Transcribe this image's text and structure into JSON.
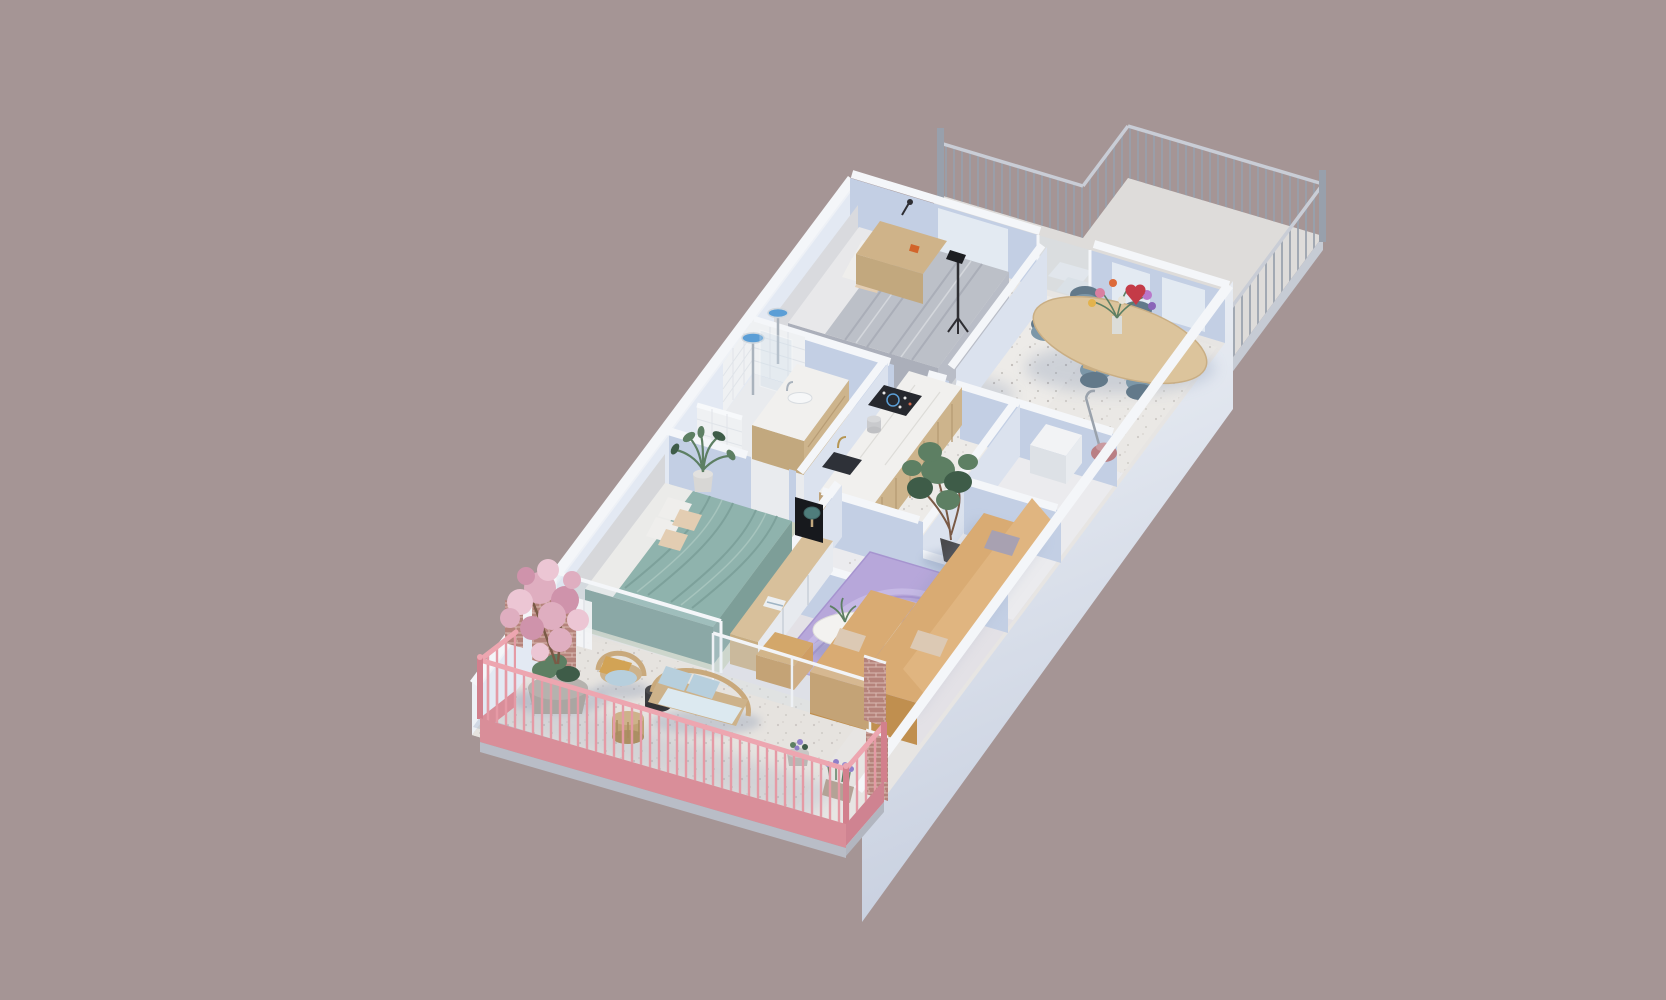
{
  "scene": {
    "title": "3D isometric cutaway floor plan of a furnished apartment with balcony and roof terrace",
    "view": "axonometric dollhouse render"
  },
  "colors": {
    "background": "#a59595",
    "terrace-floor": "#dedcda",
    "terrace-fascia": "#c6cbd4",
    "railing-metal": "#98a0ac",
    "railing-metal-rail": "#c9cdd6",
    "floor-base": "#e7e5e3",
    "floor-room": "#eae8e5",
    "floor-hall": "#edebe8",
    "floor-sage": "#ccd3c2",
    "floor-living": "#e3e1e6",
    "floor-bath": "#e9ebee",
    "floor-rooms": "#ebebee",
    "floor-balcony": "#e6e3df",
    "wall-top": "#f4f6f9",
    "wall-face-light": "#dbe2ee",
    "wall-face-shadow": "#c3cfe4",
    "wall-face-inner": "#e3e9f3",
    "wall-outer": "#eef1f6",
    "facade-top": "#f2f5f9",
    "facade-bottom": "#c7cfdf",
    "shadow-blue": "#7d8fae",
    "window-light": "#e9eef5",
    "duvet-gray": "#bcc0c8",
    "duvet-gray-dark": "#abafba",
    "sheet-white": "#e8e8ea",
    "headboard-gray": "#d9dade",
    "pillow-white": "#efeeec",
    "pillow-beige": "#e3cdb2",
    "bed-teal": "#8fb3ad",
    "bed-teal-dark": "#74968f",
    "wood-desk": "#cfb389",
    "table-wood": "#dcc49c",
    "chair-blue": "#7c97a8",
    "chair-blue-dark": "#62798a",
    "kitchen-wood": "#cdb48c",
    "kitchen-wood-dark": "#bfa37a",
    "marble-white": "#f1f0ee",
    "cooktop-black": "#26282e",
    "sink-dark": "#2e3138",
    "brass": "#b69653",
    "chrome": "#aab3bd",
    "console-wood": "#d8c09b",
    "lamp-teal": "#4f7d7c",
    "rug-lilac": "#b7a7da",
    "rug-lilac-light": "#c9bce6",
    "rug-lilac-dark": "#a694cf",
    "coffee-table-white": "#f3f2f0",
    "sofa-camel": "#d9ab73",
    "sofa-camel-side": "#cf9e63",
    "sofa-camel-front": "#c08f4f",
    "cushion-beige": "#dcc9b4",
    "cushion-gray": "#a8a1b1",
    "ottoman-camel": "#d3a76a",
    "rattan": "#c9a97c",
    "rattan-seat": "#cdb28a",
    "cushion-blue": "#b7cfdd",
    "seat-pale": "#dce9f0",
    "plant-green": "#5d7f63",
    "plant-green-dark": "#3e5c48",
    "trunk-brown": "#7a5a46",
    "pot-gray": "#c8c7c5",
    "pot-dark": "#4a4a4c",
    "blossom-pink": "#dfaec0",
    "blossom-pink-light": "#ecc6d4",
    "blossom-pink-deep": "#cf93ab",
    "brick": "#b5837b",
    "brick-light": "#d9b9b2",
    "railing-pink": "#e59aa5",
    "railing-pink-top": "#eda6b0",
    "railing-pink-dark": "#d2808d",
    "railing-pink-fascia": "#d98e99",
    "vacuum-pink": "#b97f84",
    "glass-tint": "#cfe0ec",
    "white-goods": "#f2f3f5",
    "white-goods-side": "#dde1e6",
    "tile-white": "#eff1f3"
  },
  "rooms": [
    {
      "id": "terrace",
      "label": "Roof terrace",
      "items": [
        "metal railing",
        "entry steps"
      ]
    },
    {
      "id": "master-bedroom",
      "label": "Master bedroom",
      "items": [
        "double bed",
        "gray duvet",
        "headboard",
        "wooden desk",
        "floor lamp"
      ]
    },
    {
      "id": "dining-room",
      "label": "Dining room",
      "items": [
        "oval wooden table",
        "six blue chairs",
        "flower bouquet"
      ]
    },
    {
      "id": "hallway",
      "label": "Hallway",
      "items": [
        "potted ficus tree"
      ]
    },
    {
      "id": "bathroom",
      "label": "Bathroom",
      "items": [
        "walk-in shower",
        "rain shower heads",
        "vanity with sink",
        "tiled walls"
      ]
    },
    {
      "id": "kitchen",
      "label": "Kitchen",
      "items": [
        "wood slat island",
        "marble counter",
        "induction cooktop",
        "dark sink",
        "brass tap"
      ]
    },
    {
      "id": "storage-room",
      "label": "Storage room",
      "items": [
        "vacuum cleaner",
        "white appliance"
      ]
    },
    {
      "id": "closet-room",
      "label": "Closet room",
      "items": []
    },
    {
      "id": "bedroom-2",
      "label": "Second bedroom",
      "items": [
        "double bed",
        "teal duvet",
        "palm plant",
        "curtain",
        "window wall"
      ]
    },
    {
      "id": "living-room",
      "label": "Living room",
      "items": [
        "camel corner sofa",
        "lilac swirl rug",
        "round coffee table",
        "tv console",
        "television",
        "mushroom lamp",
        "ottoman",
        "glass balustrade",
        "brick piers"
      ]
    },
    {
      "id": "balcony",
      "label": "Balcony",
      "items": [
        "pink railing",
        "cherry blossom espalier",
        "large planter",
        "rattan armchair",
        "rattan loveseat",
        "side tables",
        "flower pots"
      ]
    }
  ]
}
